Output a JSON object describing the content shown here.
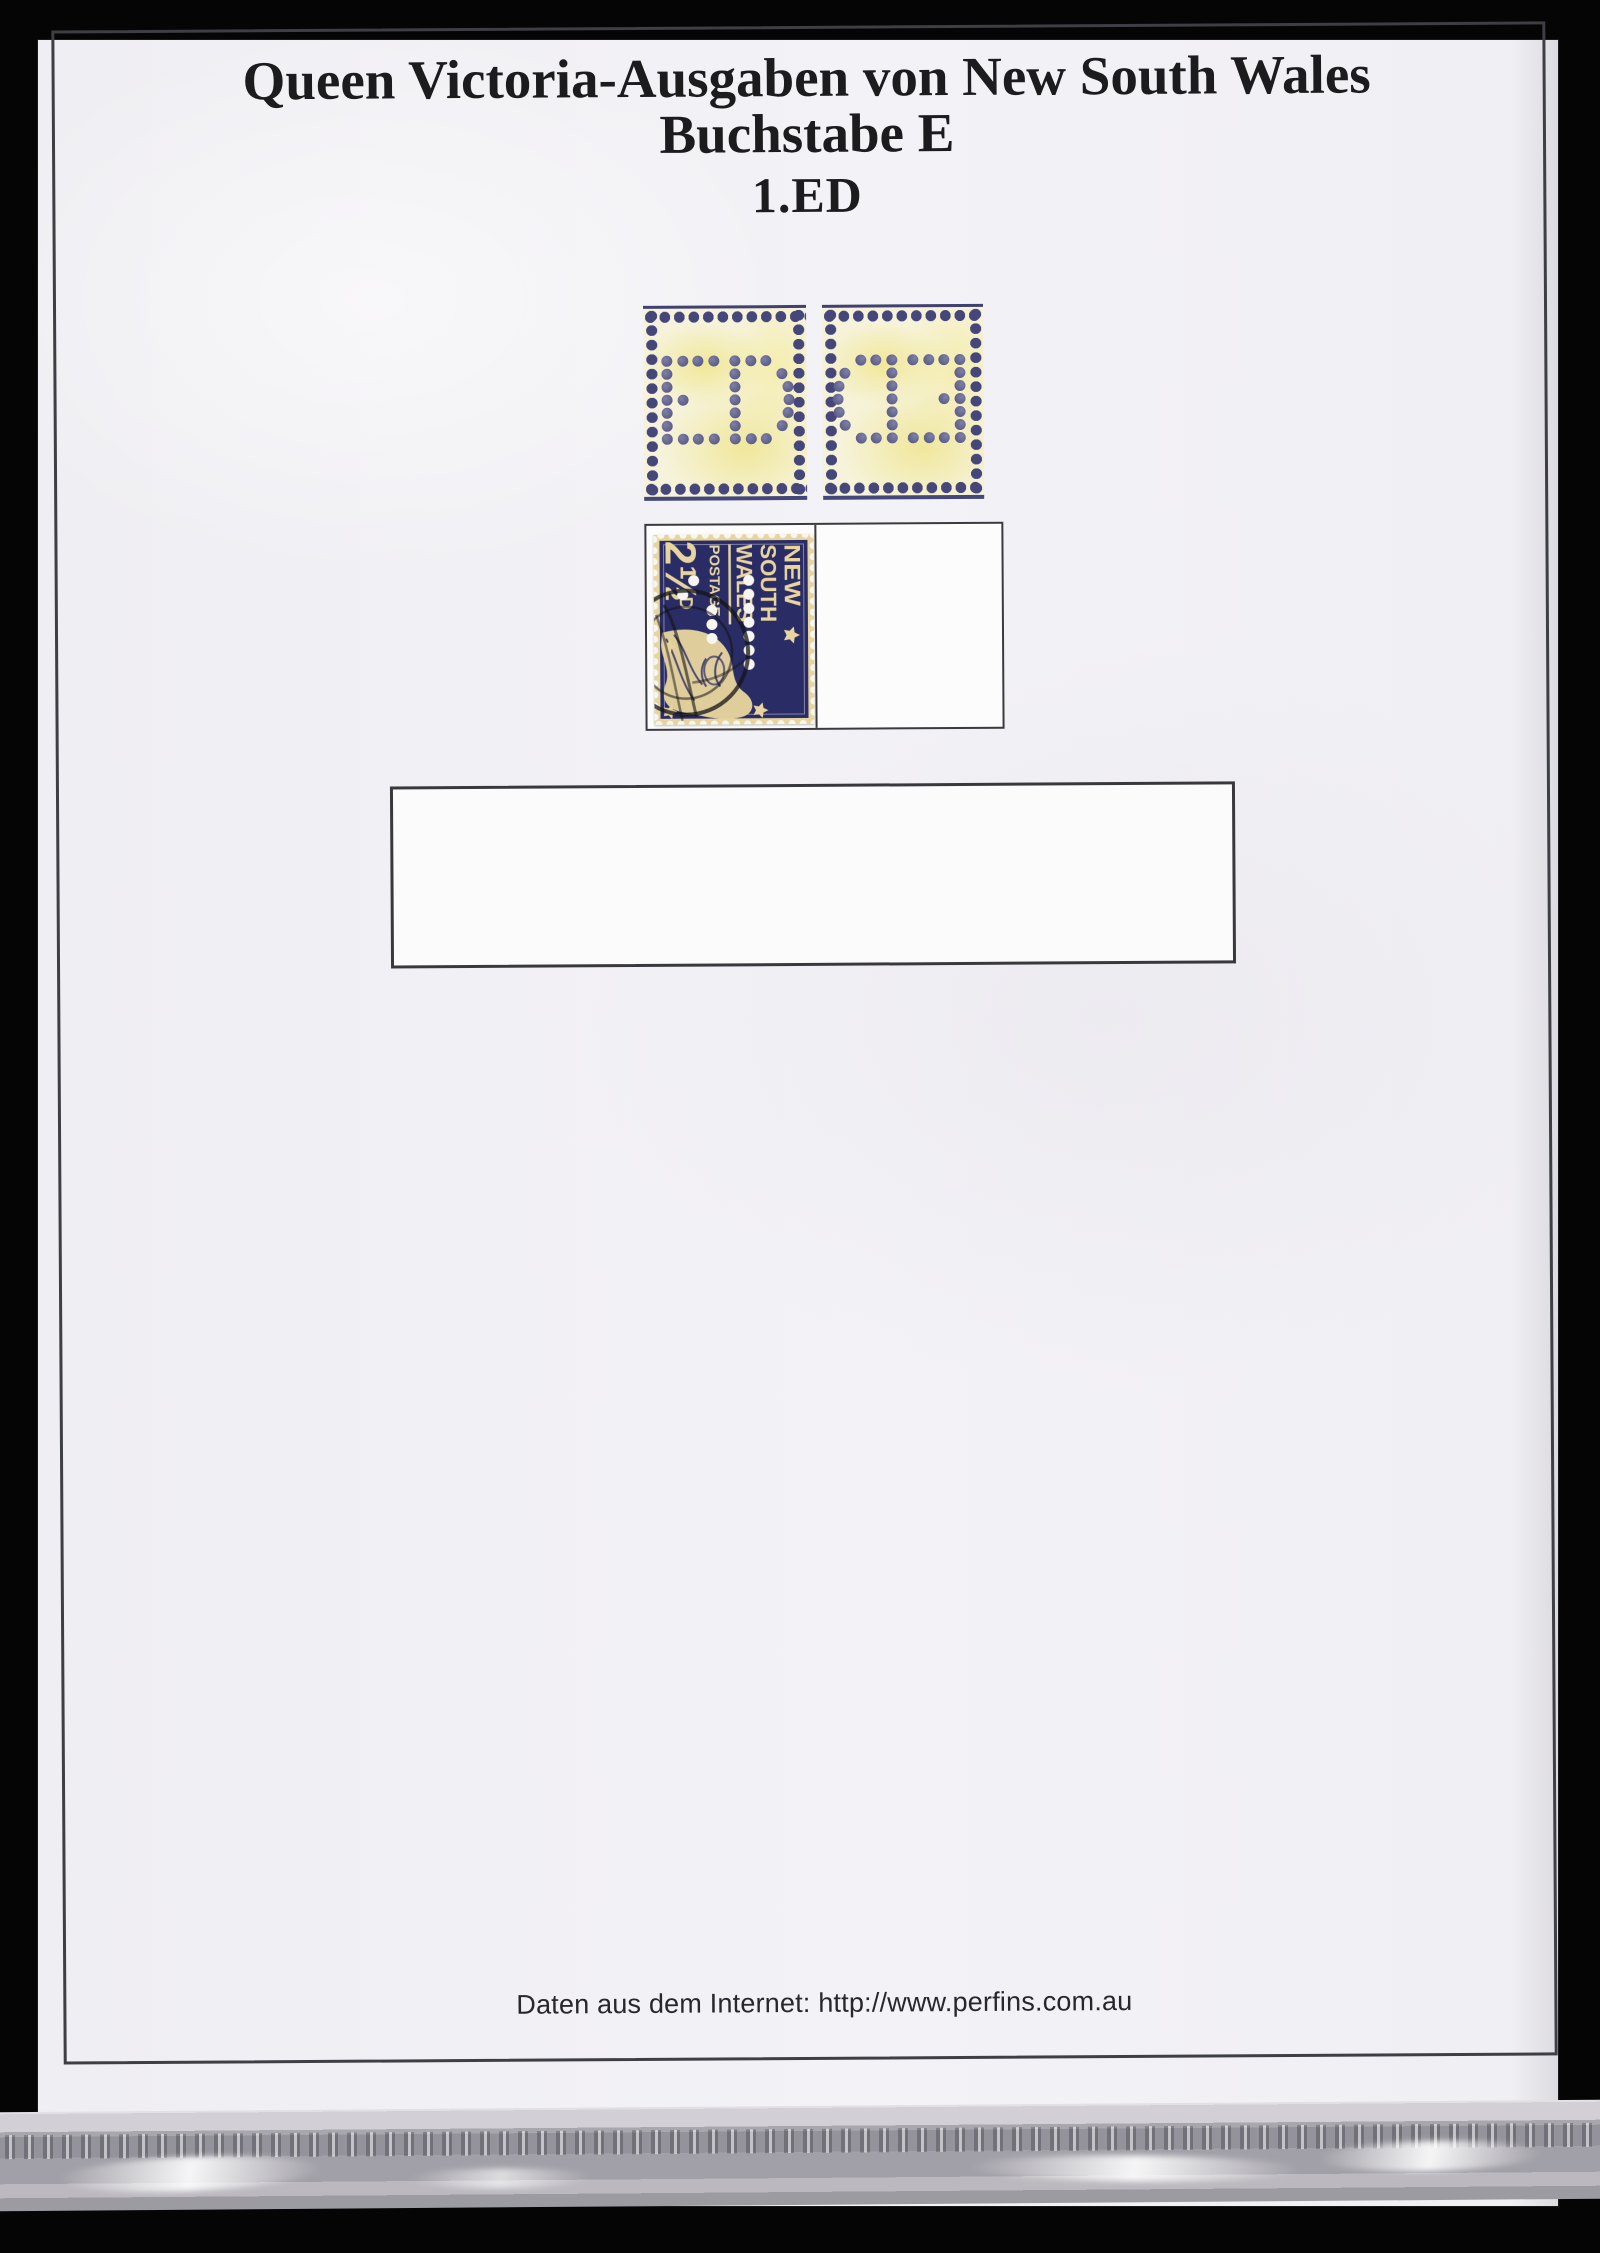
{
  "document": {
    "title_line1": "Queen Victoria-Ausgaben von New South Wales",
    "title_line2": "Buchstabe E",
    "title_line3": "1.ED",
    "footer_note": "Daten aus dem Internet: http://www.perfins.com.au"
  },
  "perfin": {
    "letters": "ED",
    "specimens": [
      {
        "id": "front",
        "mirrored": false
      },
      {
        "id": "back",
        "mirrored": true
      }
    ]
  },
  "stamp": {
    "country_line1": "NEW",
    "country_line2": "SOUTH",
    "country_line3": "WALES",
    "postage_label": "POSTAGE",
    "value_big": "2½",
    "value_small": "D"
  },
  "colors": {
    "page": "#f2f1f4",
    "frame_border": "#3e3e45",
    "specimen_paper": "#f6f3da",
    "specimen_edge_dot": "#45477b",
    "perfin_hole_dot": "#5c5e88",
    "stamp_navy": "#2a2c66",
    "stamp_cream": "#e7d49e",
    "background": "#050505"
  }
}
